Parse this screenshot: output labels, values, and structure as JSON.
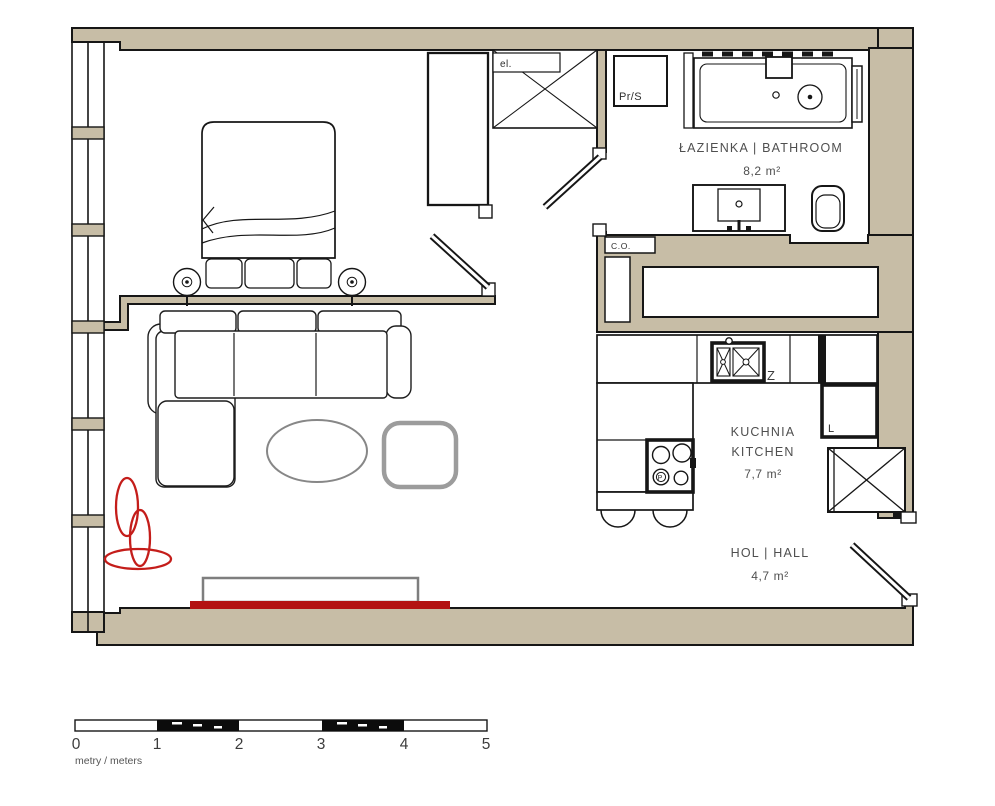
{
  "plan": {
    "rooms": {
      "bathroom": {
        "name": "ŁAZIENKA | BATHROOM",
        "area": "8,2 m²"
      },
      "kitchen": {
        "name_pl": "KUCHNIA",
        "name_en": "KITCHEN",
        "area": "7,7 m²"
      },
      "hall": {
        "name": "HOL | HALL",
        "area": "4,7 m²"
      }
    },
    "labels": {
      "washer_dryer": "Pr/S",
      "electrical": "el.",
      "heating": "C.O.",
      "sink": "Z",
      "fridge": "L",
      "hob": "P"
    },
    "colors": {
      "wall": "#c7bda6",
      "outline": "#161616",
      "tv_red": "#b31312",
      "plant_red": "#c41d1a"
    }
  },
  "scale_bar": {
    "ticks": [
      "0",
      "1",
      "2",
      "3",
      "4",
      "5"
    ],
    "unit_label": "metry / meters"
  }
}
